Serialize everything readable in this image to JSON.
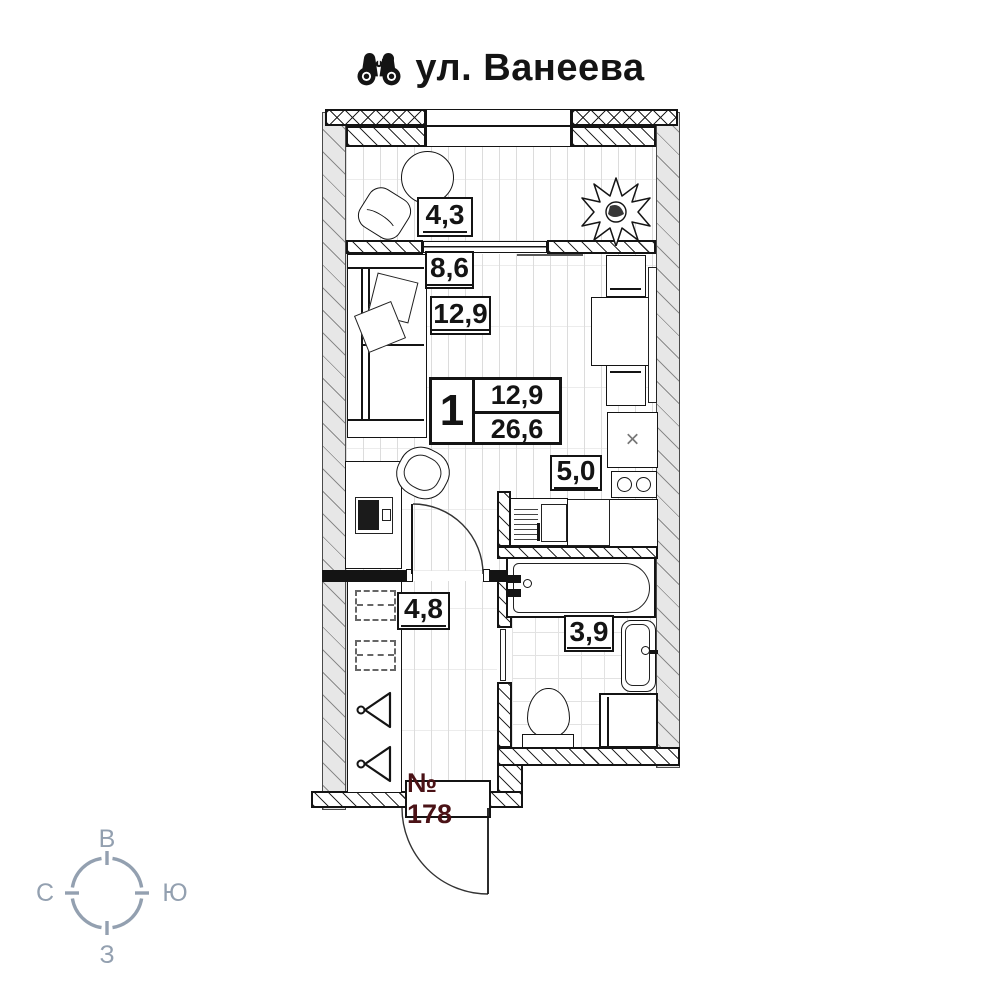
{
  "header": {
    "title": "ул. Ванеева",
    "icon": "binoculars"
  },
  "plan": {
    "areas": {
      "balcony": "4,3",
      "zone_secondary": "8,6",
      "living": "12,9",
      "kitchen": "5,0",
      "hallway": "4,8",
      "bathroom": "3,9"
    },
    "info_box": {
      "rooms": "1",
      "living_area": "12,9",
      "total_area": "26,6"
    },
    "apartment_number": "№ 178",
    "fridge_mark": "×"
  },
  "compass": {
    "top": "В",
    "right": "Ю",
    "bottom": "З",
    "left": "С"
  },
  "colors": {
    "wall_gray": "#e7e7e7",
    "line_black": "#141414",
    "apartment_number_red": "#4a1216",
    "compass_gray": "#93a0b0"
  }
}
